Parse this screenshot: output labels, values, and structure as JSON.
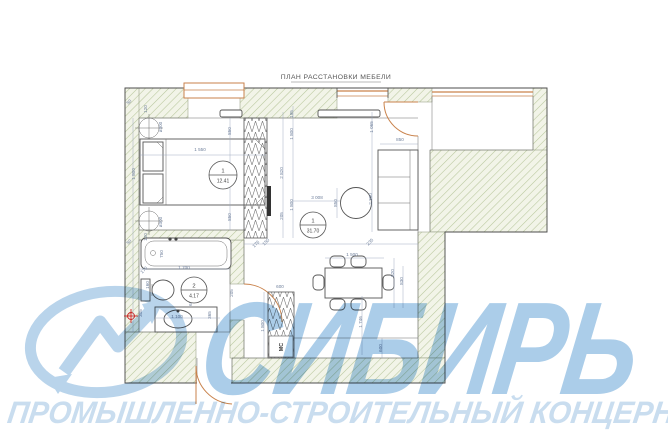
{
  "title": "ПЛАН РАССТАНОВКИ МЕБЕЛИ",
  "watermark": {
    "name": "СИБИРЬ",
    "tagline": "ПРОМЫШЛЕННО-СТРОИТЕЛЬНЫЙ КОНЦЕРН",
    "text_color": "#abcde9",
    "tagline_color": "#c9ddef",
    "logo_color": "#b9d4eb"
  },
  "rooms": [
    {
      "number": "1",
      "area": "12.41"
    },
    {
      "number": "1",
      "area": "31.70"
    },
    {
      "number": "2",
      "area": "4.17"
    }
  ],
  "appliance_label": "МС",
  "colors": {
    "wall_hatch_line": "#b7c69b",
    "wall_hatch_bg": "#f2f4e8",
    "plan_line": "#4c4c4c",
    "dimension": "#6e7f9b",
    "door_window_orange": "#c9824b",
    "riser_marker_red": "#cc2222"
  },
  "dims": [
    {
      "t": "50",
      "x": 130,
      "y": 103,
      "r": -45
    },
    {
      "t": "120",
      "x": 147,
      "y": 109,
      "r": -90
    },
    {
      "t": "ø300",
      "x": 162,
      "y": 127,
      "r": -90
    },
    {
      "t": "850",
      "x": 231,
      "y": 131,
      "r": -90
    },
    {
      "t": "1 550",
      "x": 200,
      "y": 151,
      "r": 0
    },
    {
      "t": "1 800",
      "x": 135,
      "y": 174,
      "r": -90
    },
    {
      "t": "850",
      "x": 231,
      "y": 217,
      "r": -90
    },
    {
      "t": "ø300",
      "x": 162,
      "y": 222,
      "r": -90
    },
    {
      "t": "120",
      "x": 147,
      "y": 237,
      "r": -90
    },
    {
      "t": "50",
      "x": 130,
      "y": 243,
      "r": -45
    },
    {
      "t": "195",
      "x": 293,
      "y": 114,
      "r": -90
    },
    {
      "t": "1 800",
      "x": 293,
      "y": 134,
      "r": -90
    },
    {
      "t": "2 820",
      "x": 283,
      "y": 173,
      "r": -90
    },
    {
      "t": "1 800",
      "x": 293,
      "y": 205,
      "r": -90
    },
    {
      "t": "205",
      "x": 283,
      "y": 216,
      "r": -90
    },
    {
      "t": "1 065",
      "x": 373,
      "y": 127,
      "r": -90
    },
    {
      "t": "850",
      "x": 400,
      "y": 141,
      "r": 0
    },
    {
      "t": "2 300",
      "x": 372,
      "y": 199,
      "r": -90
    },
    {
      "t": "3 008",
      "x": 317,
      "y": 199,
      "r": 0
    },
    {
      "t": "850",
      "x": 337,
      "y": 203,
      "r": -90
    },
    {
      "t": "176",
      "x": 257,
      "y": 245,
      "r": -45
    },
    {
      "t": "150",
      "x": 267,
      "y": 243,
      "r": -45
    },
    {
      "t": "235",
      "x": 371,
      "y": 243,
      "r": -45
    },
    {
      "t": "1 500",
      "x": 352,
      "y": 256,
      "r": 0
    },
    {
      "t": "820",
      "x": 394,
      "y": 273,
      "r": -90
    },
    {
      "t": "830",
      "x": 403,
      "y": 281,
      "r": -90
    },
    {
      "t": "600",
      "x": 280,
      "y": 288,
      "r": 0
    },
    {
      "t": "1 800",
      "x": 264,
      "y": 326,
      "r": -90
    },
    {
      "t": "1 746",
      "x": 362,
      "y": 322,
      "r": -90
    },
    {
      "t": "600",
      "x": 382,
      "y": 348,
      "r": -90
    },
    {
      "t": "750",
      "x": 163,
      "y": 254,
      "r": -90
    },
    {
      "t": "170",
      "x": 145,
      "y": 271,
      "r": -45
    },
    {
      "t": "1 700",
      "x": 184,
      "y": 269,
      "r": 0
    },
    {
      "t": "160",
      "x": 149,
      "y": 285,
      "r": -90
    },
    {
      "t": "630",
      "x": 192,
      "y": 302,
      "r": -90
    },
    {
      "t": "205",
      "x": 233,
      "y": 293,
      "r": -90
    },
    {
      "t": "1 100",
      "x": 177,
      "y": 318,
      "r": 0
    },
    {
      "t": "365",
      "x": 211,
      "y": 315,
      "r": -90
    },
    {
      "t": "305",
      "x": 142,
      "y": 313,
      "r": -90
    }
  ]
}
